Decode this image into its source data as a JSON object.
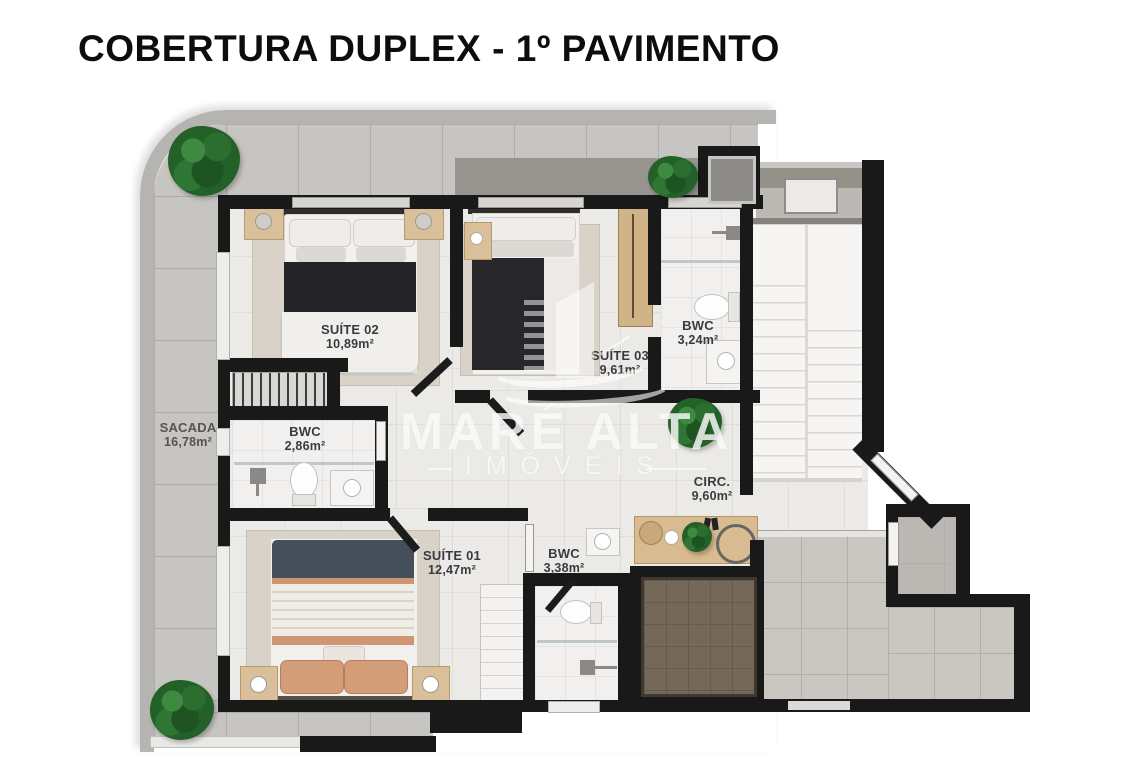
{
  "title": "COBERTURA DUPLEX - 1º PAVIMENTO",
  "watermark": {
    "brand": "MARÉ ALTA",
    "subtitle": "IMÓVEIS"
  },
  "rooms": {
    "suite02": {
      "name": "SUÍTE 02",
      "area": "10,89m²"
    },
    "suite03": {
      "name": "SUÍTE 03",
      "area": "9,61m²"
    },
    "bwc_top": {
      "name": "BWC",
      "area": "3,24m²"
    },
    "sacada": {
      "name": "SACADA",
      "area": "16,78m²"
    },
    "bwc_left": {
      "name": "BWC",
      "area": "2,86m²"
    },
    "suite01": {
      "name": "SUÍTE 01",
      "area": "12,47m²"
    },
    "bwc_bottom": {
      "name": "BWC",
      "area": "3,38m²"
    },
    "circ": {
      "name": "CIRC.",
      "area": "9,60m²"
    }
  },
  "colors": {
    "wall": "#191919",
    "terrace_tile": "#c7c5c1",
    "interior_floor": "#eceae7",
    "wood": "#d9c09a",
    "bed_dark": "#242426",
    "bed_navy": "#454f5c",
    "bed_salmon": "#d49d7a",
    "planter_dark": "#746858",
    "plant_green": "#246128"
  }
}
